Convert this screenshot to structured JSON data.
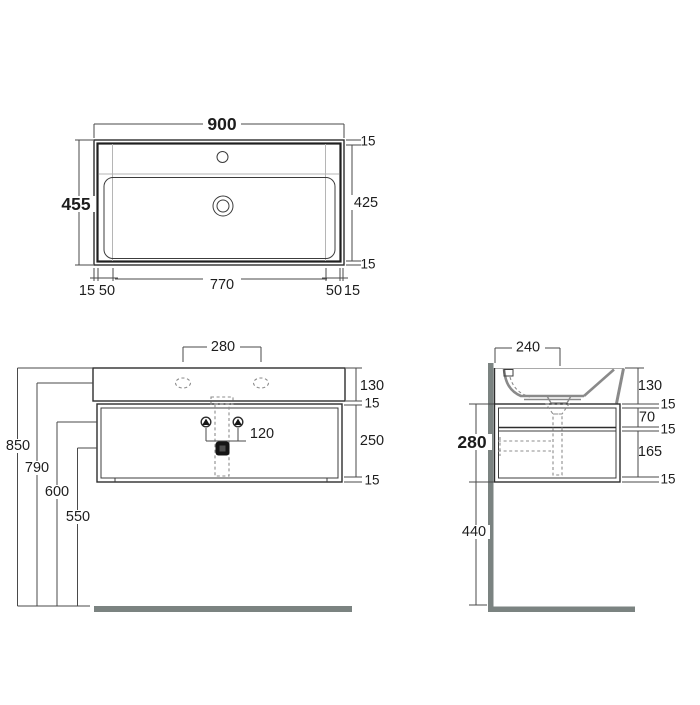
{
  "drawing": {
    "type": "technical-dimension-drawing",
    "subject": "wall-hung washbasin with cabinet",
    "views": [
      "plan",
      "front-elevation",
      "side-section"
    ]
  },
  "colors": {
    "line": "#2d2d2d",
    "dimension_line": "#4a4a4a",
    "light_line": "#b5b5b5",
    "profile_gray": "#8a8a8a",
    "wall_floor_bar": "#7b8381",
    "background": "#ffffff"
  },
  "top_view": {
    "dim_width": "900",
    "dim_depth": "455",
    "dim_inner_depth": "425",
    "dim_rim_top": "15",
    "dim_rim_bottom": "15",
    "dim_bottom_left_rim": "15",
    "dim_bottom_left_offset": "50",
    "dim_bottom_inner_width": "770",
    "dim_bottom_right_offset": "50",
    "dim_bottom_right_rim": "15"
  },
  "front_view": {
    "dim_tap_centres": "280",
    "dim_basin_height": "130",
    "dim_top_panel": "15",
    "dim_drawer_front": "250",
    "dim_bottom_panel": "15",
    "dim_bolt_centres": "120",
    "dim_height_total": "850",
    "dim_height_rim": "790",
    "dim_height_bolts": "600",
    "dim_height_trap": "550"
  },
  "side_view": {
    "dim_drain_from_wall": "240",
    "dim_basin_height": "130",
    "dim_top_panel": "15",
    "dim_upper_gap": "70",
    "dim_shelf": "15",
    "dim_drawer_depth": "165",
    "dim_bottom_panel": "15",
    "dim_cabinet_height": "280",
    "dim_floor_clearance": "440"
  }
}
